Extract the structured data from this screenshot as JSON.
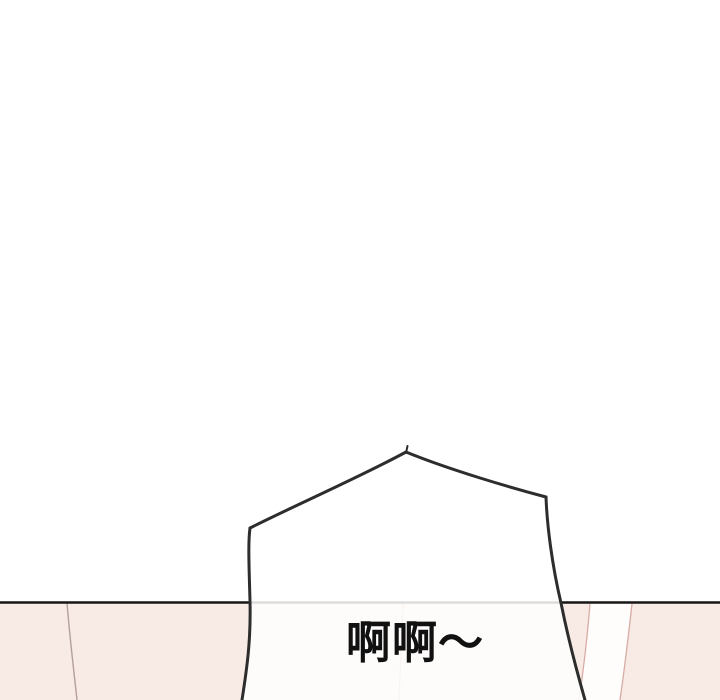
{
  "page": {
    "background_color": "#ffffff",
    "description_text": ""
  },
  "panel": {
    "fill": "#f8eae5",
    "border_color": "#161616",
    "left_line_color": "#b3a09a",
    "detail_line_color": "#d8aca4",
    "under_bubble_line_color": "#d9b6ae",
    "highlight_fill": "#fefdfc"
  },
  "bubble": {
    "text": "啊啊～",
    "text_color": "#111111",
    "fill_rgba": "rgba(255,255,255,0.85)",
    "stroke": "#2d2d2d"
  }
}
